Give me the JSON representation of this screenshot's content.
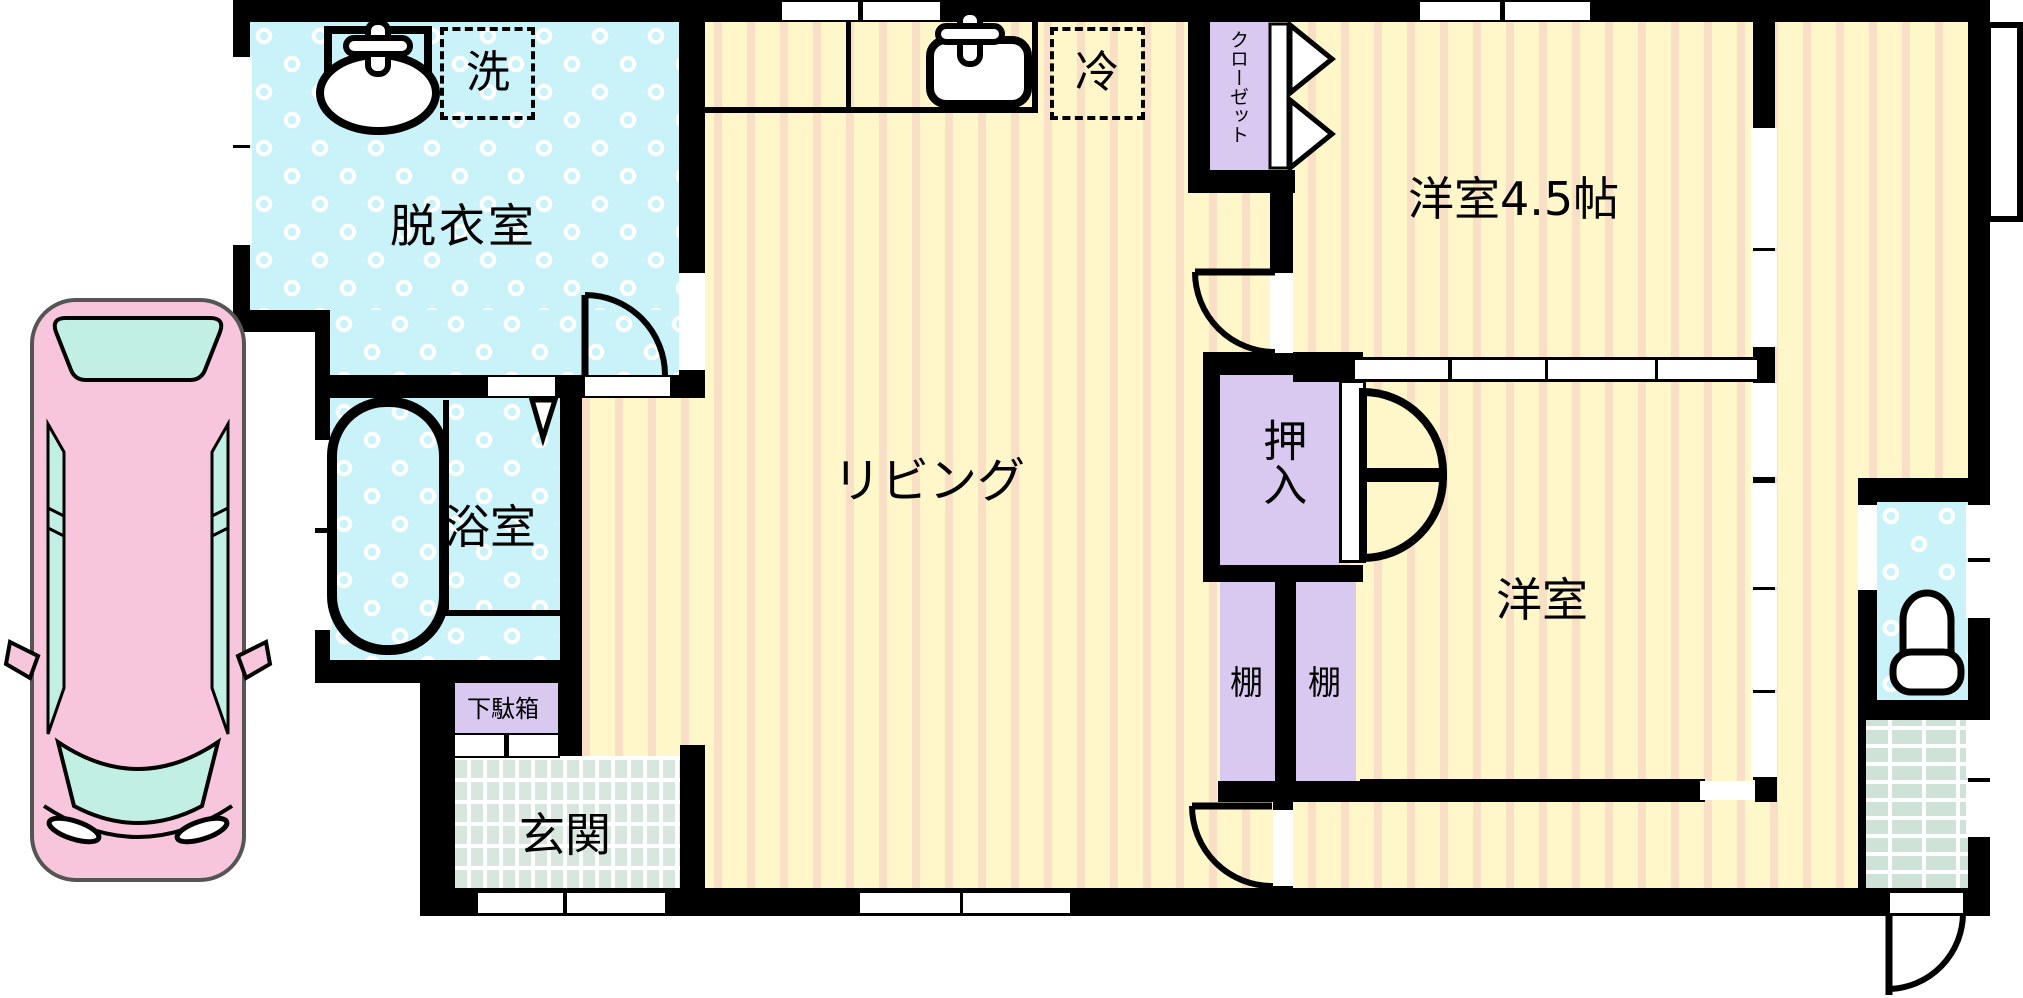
{
  "plan": {
    "type": "japanese-floor-plan",
    "rooms": [
      {
        "name": "dressing-room",
        "label": "脱衣室"
      },
      {
        "name": "bathroom",
        "label": "浴室"
      },
      {
        "name": "entrance",
        "label": "玄関"
      },
      {
        "name": "living",
        "label": "リビング"
      },
      {
        "name": "western-room-4-5",
        "label": "洋室4.5帖"
      },
      {
        "name": "western-room",
        "label": "洋室"
      }
    ],
    "fixtures": {
      "washing_machine": "洗",
      "refrigerator": "冷",
      "closet": "クローゼット",
      "oshiire": "押入",
      "shelf_left": "棚",
      "shelf_right": "棚",
      "shoe_cabinet": "下駄箱"
    },
    "colors": {
      "room_yellow": "#FFF7CA",
      "room_stripe": "#F9DFC5",
      "water_blue": "#C9F2F9",
      "storage_purple": "#D9C8EF",
      "tile_green": "#D7E7DE",
      "porch_green": "#CFE2D8",
      "wall": "#000000",
      "car_pink": "#F7C6DC",
      "car_glass": "#C2EFE4"
    }
  }
}
